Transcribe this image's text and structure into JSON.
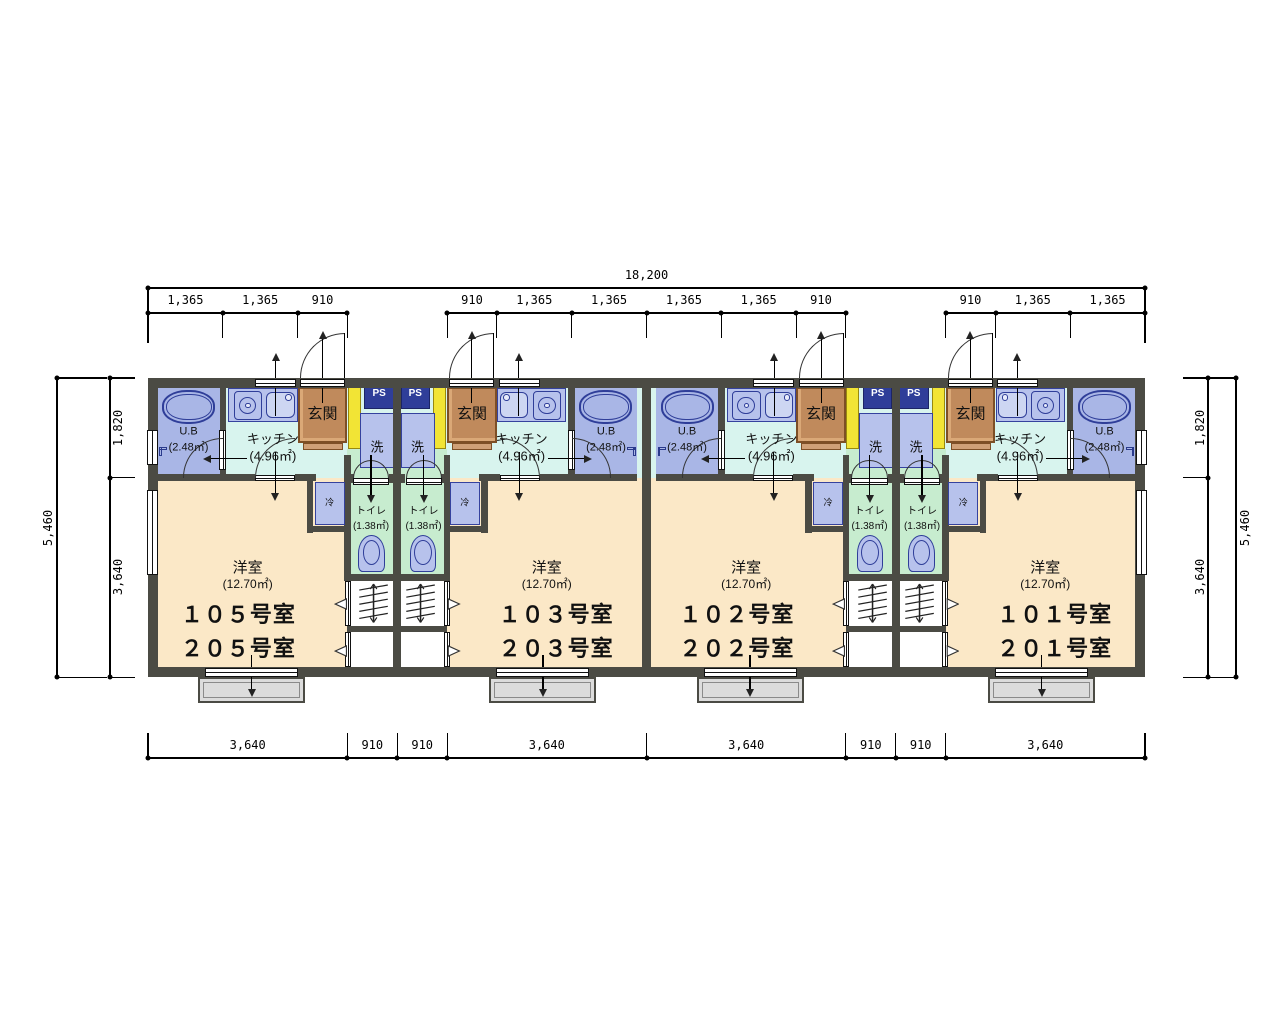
{
  "room_names": {
    "living": "洋室",
    "living_area": "(12.70㎡)",
    "kitchen": "キッチン",
    "kitchen_area": "(4.96㎡)",
    "bath": "U.B",
    "bath_area": "(2.48㎡)",
    "toilet": "トイレ",
    "toilet_area": "(1.38㎡)",
    "entrance": "玄関",
    "washer": "洗",
    "fridge": "冷",
    "pipe_space": "PS"
  },
  "units": [
    {
      "id": "105",
      "labels": [
        "１０５号室",
        "２０５号室"
      ]
    },
    {
      "id": "103",
      "labels": [
        "１０３号室",
        "２０３号室"
      ]
    },
    {
      "id": "102",
      "labels": [
        "１０２号室",
        "２０２号室"
      ]
    },
    {
      "id": "101",
      "labels": [
        "１０１号室",
        "２０１号室"
      ]
    }
  ],
  "dimensions": {
    "top_total": "18,200",
    "top_segments": [
      "1,365",
      "1,365",
      "910",
      "910",
      "1,365",
      "1,365",
      "1,365",
      "1,365",
      "910",
      "910",
      "1,365",
      "1,365"
    ],
    "bottom_segments": [
      "3,640",
      "910",
      "910",
      "3,640",
      "3,640",
      "910",
      "910",
      "3,640"
    ],
    "side_segments": [
      "1,820",
      "3,640"
    ],
    "side_total": "5,460"
  },
  "colors": {
    "wall": "#4b4b44",
    "living": "#fbe8c7",
    "kitchen": "#d8f4ee",
    "toilet_room": "#c7eccf",
    "fixture": "#b7c2ec",
    "fixture_border": "#2f3e99",
    "pipe_space_bg": "#2f3e99",
    "entrance_bg": "#c08a5c",
    "entrance_border": "#7d4f26",
    "shoe_cabinet": "#f2e435",
    "balcony": "#dcdcdc"
  }
}
